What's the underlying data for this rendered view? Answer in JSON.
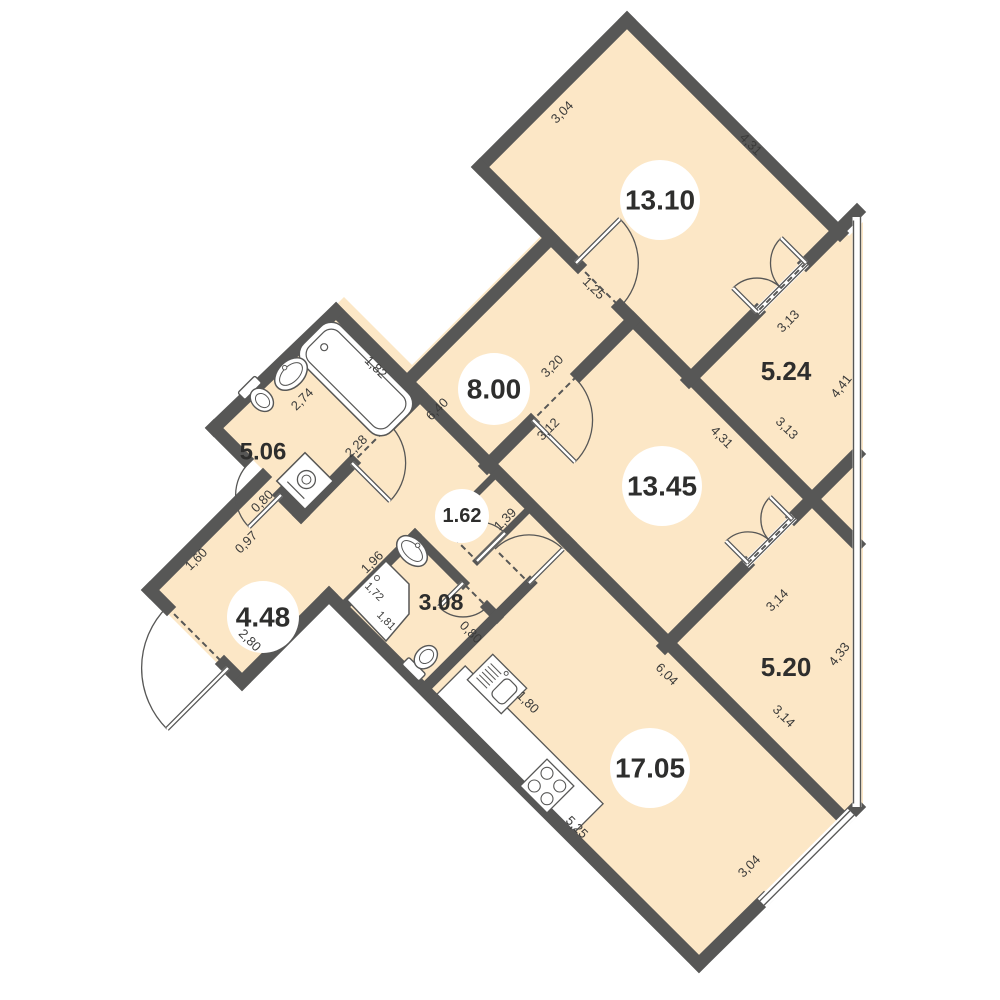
{
  "meta": {
    "bg_color": "#ffffff",
    "floor_color": "#fce7c6",
    "wall_color": "#575756",
    "text_color": "#3b3b3a",
    "room_text_color": "#2e2e2d",
    "fixture_stroke": "#575756"
  },
  "outline": [
    [
      627,
      14
    ],
    [
      849,
      236
    ],
    [
      863,
      222
    ],
    [
      863,
      808
    ],
    [
      700,
      971
    ],
    [
      323,
      594
    ],
    [
      236,
      682
    ],
    [
      144,
      590
    ],
    [
      264,
      471
    ],
    [
      217,
      424
    ],
    [
      344,
      297
    ],
    [
      412,
      365
    ],
    [
      548,
      229
    ],
    [
      480,
      161
    ]
  ],
  "walls": [
    [
      627,
      20,
      840,
      233,
      13
    ],
    [
      627,
      20,
      480,
      167,
      13
    ],
    [
      480,
      167,
      578,
      265,
      13
    ],
    [
      620,
      307,
      857,
      544,
      13
    ],
    [
      857,
      212,
      806,
      263,
      13
    ],
    [
      757,
      312,
      689,
      380,
      13
    ],
    [
      633,
      320,
      579,
      374,
      13
    ],
    [
      531,
      422,
      487,
      466,
      13
    ],
    [
      551,
      238,
      406,
      383,
      13
    ],
    [
      336,
      311,
      419,
      394,
      13
    ],
    [
      419,
      394,
      568,
      543,
      13
    ],
    [
      568,
      543,
      843,
      818,
      13
    ],
    [
      857,
      454,
      794,
      517,
      13
    ],
    [
      746,
      565,
      665,
      646,
      13
    ],
    [
      419,
      396,
      394,
      421,
      13
    ],
    [
      352,
      463,
      301,
      515,
      13
    ],
    [
      301,
      515,
      281,
      495,
      13
    ],
    [
      245,
      459,
      214,
      428,
      13
    ],
    [
      214,
      428,
      336,
      311,
      13
    ],
    [
      263,
      477,
      150,
      590,
      13
    ],
    [
      150,
      590,
      167,
      607,
      13
    ],
    [
      224,
      664,
      242,
      682,
      13
    ],
    [
      242,
      682,
      329,
      595,
      13
    ],
    [
      329,
      595,
      699,
      964,
      13
    ],
    [
      699,
      964,
      764,
      900,
      13
    ],
    [
      849,
      815,
      857,
      807,
      13
    ],
    [
      415,
      535,
      463,
      583,
      10
    ],
    [
      487,
      607,
      497,
      617,
      10
    ],
    [
      415,
      535,
      343,
      607,
      10
    ],
    [
      530,
      583,
      424,
      689,
      11
    ],
    [
      497,
      473,
      443,
      527,
      7
    ],
    [
      531,
      507,
      477,
      561,
      7
    ]
  ],
  "glazing": {
    "x": 857,
    "y1": 217,
    "y2": 807
  },
  "windows": [
    [
      762,
      903,
      852,
      813
    ]
  ],
  "sills": [
    [
      806,
      263,
      757,
      312
    ],
    [
      794,
      517,
      746,
      565
    ]
  ],
  "door_dashes": [
    [
      578,
      265,
      620,
      307
    ],
    [
      577,
      376,
      533,
      420
    ],
    [
      806,
      263,
      757,
      312
    ],
    [
      794,
      517,
      746,
      565
    ],
    [
      390,
      425,
      354,
      461
    ],
    [
      447,
      531,
      473,
      557
    ],
    [
      465,
      585,
      485,
      605
    ],
    [
      499,
      553,
      531,
      585
    ],
    [
      167,
      607,
      224,
      664
    ]
  ],
  "doors": [
    {
      "leaf": [
        576,
        263,
        620,
        219
      ],
      "arc": "M620,307 A62,62 0 0 0 620,219"
    },
    {
      "leaf": [
        533,
        420,
        575,
        462
      ],
      "arc": "M575,378 A59,59 0 0 1 575,462"
    },
    {
      "leaf": [
        352,
        463,
        390,
        501
      ],
      "arc": "M390,425 A54,54 0 0 1 390,501"
    },
    {
      "leaf": [
        281,
        495,
        249,
        527
      ],
      "arc": "M249,463 A45,45 0 0 0 249,527"
    },
    {
      "leaf": [
        477,
        561,
        505,
        533
      ],
      "arc": "M449,533 A40,40 0 0 1 505,533"
    },
    {
      "leaf": [
        463,
        583,
        439,
        607
      ],
      "arc": "M487,607 A34,34 0 0 1 439,607"
    },
    {
      "leaf": [
        529,
        583,
        563,
        549
      ],
      "arc": "M495,549 A48,48 0 0 1 563,549"
    },
    {
      "leaf": [
        228,
        668,
        167,
        729
      ],
      "arc": "M167,607 A86,86 0 0 0 167,729"
    },
    {
      "leaf": [
        806,
        263,
        781,
        238
      ],
      "arc": "M781,288 A35,35 0 0 1 781,238"
    },
    {
      "leaf": [
        757,
        312,
        733,
        288
      ],
      "arc": "M781,288 A34,34 0 0 0 733,288"
    },
    {
      "leaf": [
        792,
        519,
        770,
        497
      ],
      "arc": "M770,541 A31,31 0 0 1 770,497"
    },
    {
      "leaf": [
        748,
        563,
        726,
        541
      ],
      "arc": "M770,541 A31,31 0 0 0 726,541"
    }
  ],
  "fixtures": [
    {
      "type": "tub",
      "cx": 356,
      "cy": 379,
      "rot": 45,
      "len": 124,
      "w": 54
    },
    {
      "type": "sink",
      "cx": 291,
      "cy": 374,
      "rot": -45,
      "rx": 19,
      "ry": 13
    },
    {
      "type": "toilet",
      "cx": 259,
      "cy": 397,
      "rot": -45
    },
    {
      "type": "washer",
      "cx": 305,
      "cy": 481,
      "rot": 45,
      "size": 40
    },
    {
      "type": "shower",
      "pts": [
        [
          347,
          600
        ],
        [
          386,
          561
        ],
        [
          409,
          584
        ],
        [
          409,
          614
        ],
        [
          386,
          641
        ]
      ],
      "drain": [
        377,
        600
      ]
    },
    {
      "type": "sink",
      "cx": 412,
      "cy": 551,
      "rot": 45,
      "rx": 18,
      "ry": 12
    },
    {
      "type": "toilet",
      "cx": 423,
      "cy": 660,
      "rot": -135
    },
    {
      "type": "counter",
      "cx": 520,
      "cy": 749,
      "rot": 45,
      "len": 195,
      "w": 40
    },
    {
      "type": "ksink",
      "cx": 497,
      "cy": 684,
      "rot": 45
    },
    {
      "type": "stove",
      "cx": 547,
      "cy": 786,
      "rot": 45
    }
  ],
  "rooms": [
    {
      "label": "13.10",
      "x": 660,
      "y": 200,
      "r": 40,
      "fs": 28
    },
    {
      "label": "13.45",
      "x": 662,
      "y": 486,
      "r": 40,
      "fs": 28
    },
    {
      "label": "17.05",
      "x": 650,
      "y": 768,
      "r": 40,
      "fs": 28
    },
    {
      "label": "8.00",
      "x": 494,
      "y": 389,
      "r": 36,
      "fs": 28
    },
    {
      "label": "4.48",
      "x": 263,
      "y": 617,
      "r": 36,
      "fs": 28
    },
    {
      "label": "1.62",
      "x": 462,
      "y": 516,
      "r": 27,
      "fs": 20
    },
    {
      "label": "5.06",
      "x": 263,
      "y": 452,
      "r": 0,
      "fs": 24
    },
    {
      "label": "3.08",
      "x": 441,
      "y": 602,
      "r": 0,
      "fs": 23
    },
    {
      "label": "5.24",
      "x": 786,
      "y": 371,
      "r": 0,
      "fs": 26
    },
    {
      "label": "5.20",
      "x": 786,
      "y": 667,
      "r": 0,
      "fs": 26
    }
  ],
  "dimensions": [
    {
      "t": "3,04",
      "x": 562,
      "y": 112,
      "rot": -45
    },
    {
      "t": "4,31",
      "x": 751,
      "y": 144,
      "rot": 45
    },
    {
      "t": "1,25",
      "x": 594,
      "y": 288,
      "rot": 45
    },
    {
      "t": "3,20",
      "x": 552,
      "y": 366,
      "rot": -45
    },
    {
      "t": "3,12",
      "x": 548,
      "y": 429,
      "rot": -45
    },
    {
      "t": "6,40",
      "x": 437,
      "y": 409,
      "rot": -45
    },
    {
      "t": "2,28",
      "x": 356,
      "y": 446,
      "rot": -45
    },
    {
      "t": "1,82",
      "x": 376,
      "y": 367,
      "rot": 45
    },
    {
      "t": "2,74",
      "x": 302,
      "y": 399,
      "rot": -45
    },
    {
      "t": "0,80",
      "x": 262,
      "y": 501,
      "rot": -45
    },
    {
      "t": "0,97",
      "x": 246,
      "y": 542,
      "rot": -45
    },
    {
      "t": "1,60",
      "x": 196,
      "y": 559,
      "rot": -45
    },
    {
      "t": "2,80",
      "x": 250,
      "y": 640,
      "rot": 45
    },
    {
      "t": "1,96",
      "x": 372,
      "y": 562,
      "rot": -45
    },
    {
      "t": "1,39",
      "x": 505,
      "y": 519,
      "rot": -45
    },
    {
      "t": "1,72",
      "x": 374,
      "y": 592,
      "rot": 45,
      "fs": 11
    },
    {
      "t": "1,81",
      "x": 386,
      "y": 621,
      "rot": 45,
      "fs": 11
    },
    {
      "t": "0,80",
      "x": 471,
      "y": 632,
      "rot": 45
    },
    {
      "t": "1,80",
      "x": 528,
      "y": 702,
      "rot": 45
    },
    {
      "t": "5,25",
      "x": 577,
      "y": 827,
      "rot": 45
    },
    {
      "t": "6,04",
      "x": 667,
      "y": 674,
      "rot": 45
    },
    {
      "t": "3,04",
      "x": 749,
      "y": 866,
      "rot": -45
    },
    {
      "t": "3,13",
      "x": 788,
      "y": 321,
      "rot": -45
    },
    {
      "t": "3,13",
      "x": 787,
      "y": 428,
      "rot": 45
    },
    {
      "t": "4,41",
      "x": 841,
      "y": 386,
      "rot": -52
    },
    {
      "t": "4,31",
      "x": 722,
      "y": 437,
      "rot": 45
    },
    {
      "t": "3,14",
      "x": 777,
      "y": 600,
      "rot": -45
    },
    {
      "t": "3,14",
      "x": 784,
      "y": 716,
      "rot": 45
    },
    {
      "t": "4,33",
      "x": 839,
      "y": 654,
      "rot": -52
    }
  ]
}
